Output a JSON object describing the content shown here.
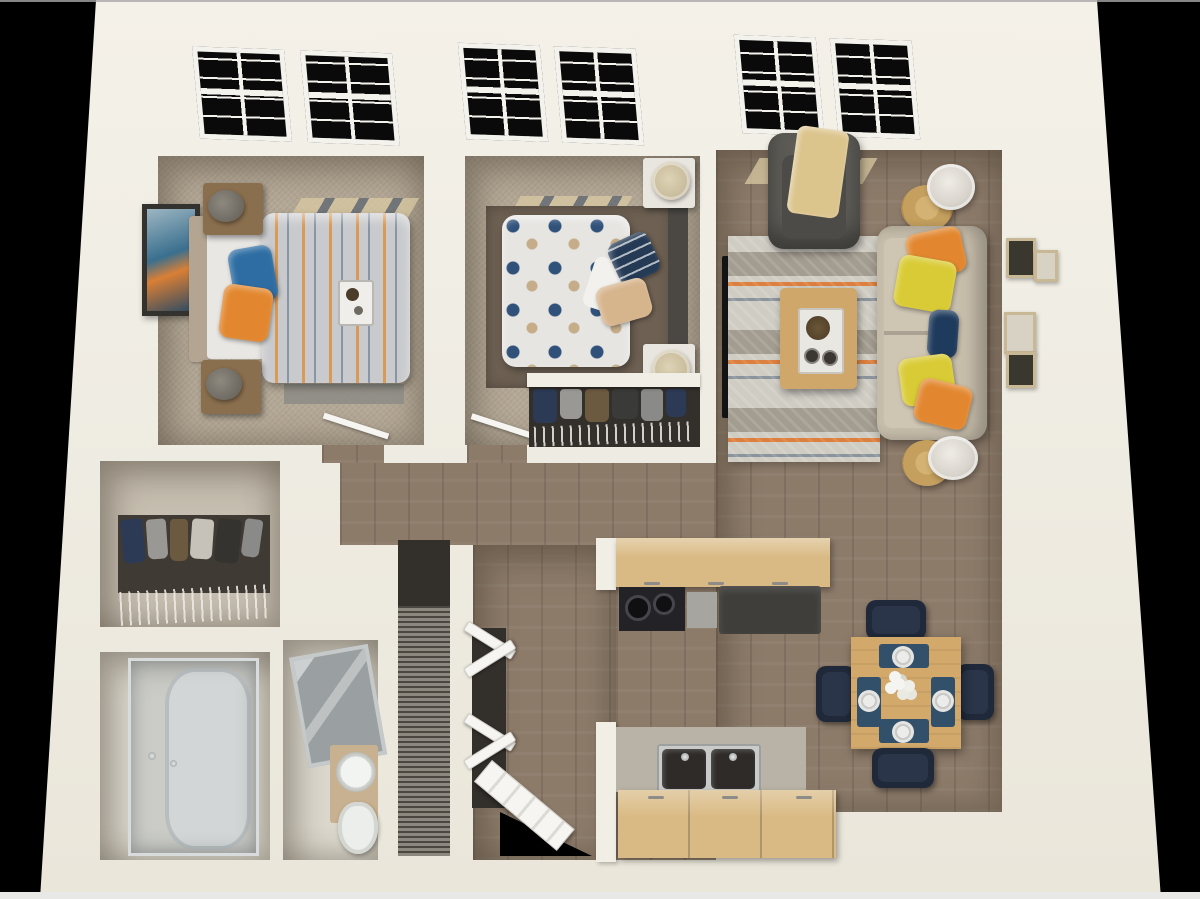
{
  "scene": {
    "type": "3d-floor-plan-render",
    "view": "top-down dollhouse perspective",
    "unit": "two-bedroom one-bath apartment",
    "background": "#000000",
    "visible_text": ""
  },
  "palette": {
    "background": "#000000",
    "wall": "#f0ede4",
    "wall_shadow": "#d8d3c7",
    "carpet": "#b3a795",
    "wood_floor": "#8d7b6a",
    "bath_floor": "#dcd8cd",
    "rug_base": "#d4d0c7",
    "rug_band_gray": "#a39c90",
    "rug_stripe_orange": "#dd7f3f",
    "rug_stripe_blue": "#8b949c",
    "sofa": "#c8beac",
    "armchair": "#5c5b56",
    "throw_blanket": "#dcc48d",
    "pillow_orange": "#e2872f",
    "pillow_yellow": "#d9cb35",
    "pillow_navy": "#1e3a5c",
    "pillow_blue": "#2e6da3",
    "duvet_bed1": "#c9cacd",
    "duvet_bed1_stripe_orange": "#d99a55",
    "duvet_bed1_stripe_blue": "#8795a5",
    "duvet_bed2": "#e6e5e2",
    "duvet_bed2_dot_navy": "#30517a",
    "duvet_bed2_dot_tan": "#c5ad8a",
    "headboard_bed1": "#b3a591",
    "headboard_bed2": "#4b4844",
    "nightstand_wood": "#8a6f4e",
    "nightstand_white": "#e9e6df",
    "area_rug_bed2": "#6e6153",
    "table_wood": "#d2a86b",
    "chair_navy": "#20293a",
    "counter_wood": "#d9ba84",
    "counter_gray": "#b9b3a7",
    "refrigerator_dark": "#3f3e3b",
    "stove_black": "#232327",
    "stainless": "#a7a5a0",
    "sink_basin": "#2e2b28",
    "white_fixture": "#eceeec",
    "shower_glass": "#b7bfc2",
    "clothes_navy": "#2c3a55",
    "clothes_gray": "#9a9894",
    "clothes_brown": "#6b5940",
    "closet_dark": "#332f2b",
    "louver_gray": "#8c8880",
    "door_white": "#f6f5f1",
    "tv_black": "#141416",
    "frame_tan": "#c9b896",
    "art_blue": "#3a6f8e",
    "art_orange": "#d97f35",
    "window_light_patch": "#d9c9a2",
    "lamp_shade_white": "#d9d5cd",
    "lamp_shade_tan": "#c9bd9e",
    "side_table_woven": "#c49f5e"
  },
  "rooms": [
    {
      "id": "bedroom-1",
      "floor": "carpet",
      "furniture": [
        "queen-bed-striped-duvet",
        "headboard",
        "nightstand-x2",
        "table-lamp-x2",
        "wall-art-abstract",
        "breakfast-tray",
        "accent-pillows-blue-orange",
        "area-rug-gray",
        "window-double",
        "door-open"
      ]
    },
    {
      "id": "bedroom-2",
      "floor": "carpet",
      "furniture": [
        "queen-bed-polka-dot-duvet",
        "headboard-dark",
        "nightstand-white-x2",
        "table-lamp-x2",
        "accent-pillows-navy-tan",
        "area-rug-brown",
        "reach-in-closet-clothes",
        "window-double",
        "door-open"
      ]
    },
    {
      "id": "living-room",
      "floor": "wood",
      "furniture": [
        "sofa-cream",
        "throw-pillows-orange-yellow-navy",
        "armchair-gray",
        "throw-blanket-tan",
        "coffee-table",
        "serving-tray",
        "round-side-table-x2",
        "floor-lamp-x2",
        "tv-flatscreen",
        "patterned-area-rug",
        "gallery-wall-frames-x4",
        "window-double"
      ]
    },
    {
      "id": "dining-area",
      "floor": "wood",
      "furniture": [
        "square-dining-table",
        "dining-chairs-x4",
        "place-settings-x4",
        "flower-centerpiece"
      ]
    },
    {
      "id": "kitchen",
      "floor": "wood",
      "furniture": [
        "upper-cabinets",
        "range-stove",
        "dishwasher",
        "refrigerator",
        "lower-counter",
        "double-basin-sink",
        "base-cabinets"
      ]
    },
    {
      "id": "hallway",
      "floor": "wood",
      "furniture": []
    },
    {
      "id": "entry",
      "floor": "wood",
      "furniture": [
        "front-door-open",
        "coat-closet-bifold-doors"
      ]
    },
    {
      "id": "bathroom",
      "floor": "tile",
      "furniture": [
        "tub-shower-glass-enclosure",
        "faucet"
      ]
    },
    {
      "id": "vanity-room",
      "floor": "tile",
      "furniture": [
        "vanity-sink",
        "toilet",
        "mirror-door-panel"
      ]
    },
    {
      "id": "walk-in-closet",
      "floor": "carpet",
      "furniture": [
        "wire-shelving",
        "hanging-clothes"
      ]
    },
    {
      "id": "utility-closet",
      "floor": "none",
      "furniture": [
        "louvered-vent-panel"
      ]
    }
  ],
  "counts": {
    "windows": 3,
    "bedrooms": 2,
    "bathrooms": 1,
    "dining_seats": 4
  }
}
